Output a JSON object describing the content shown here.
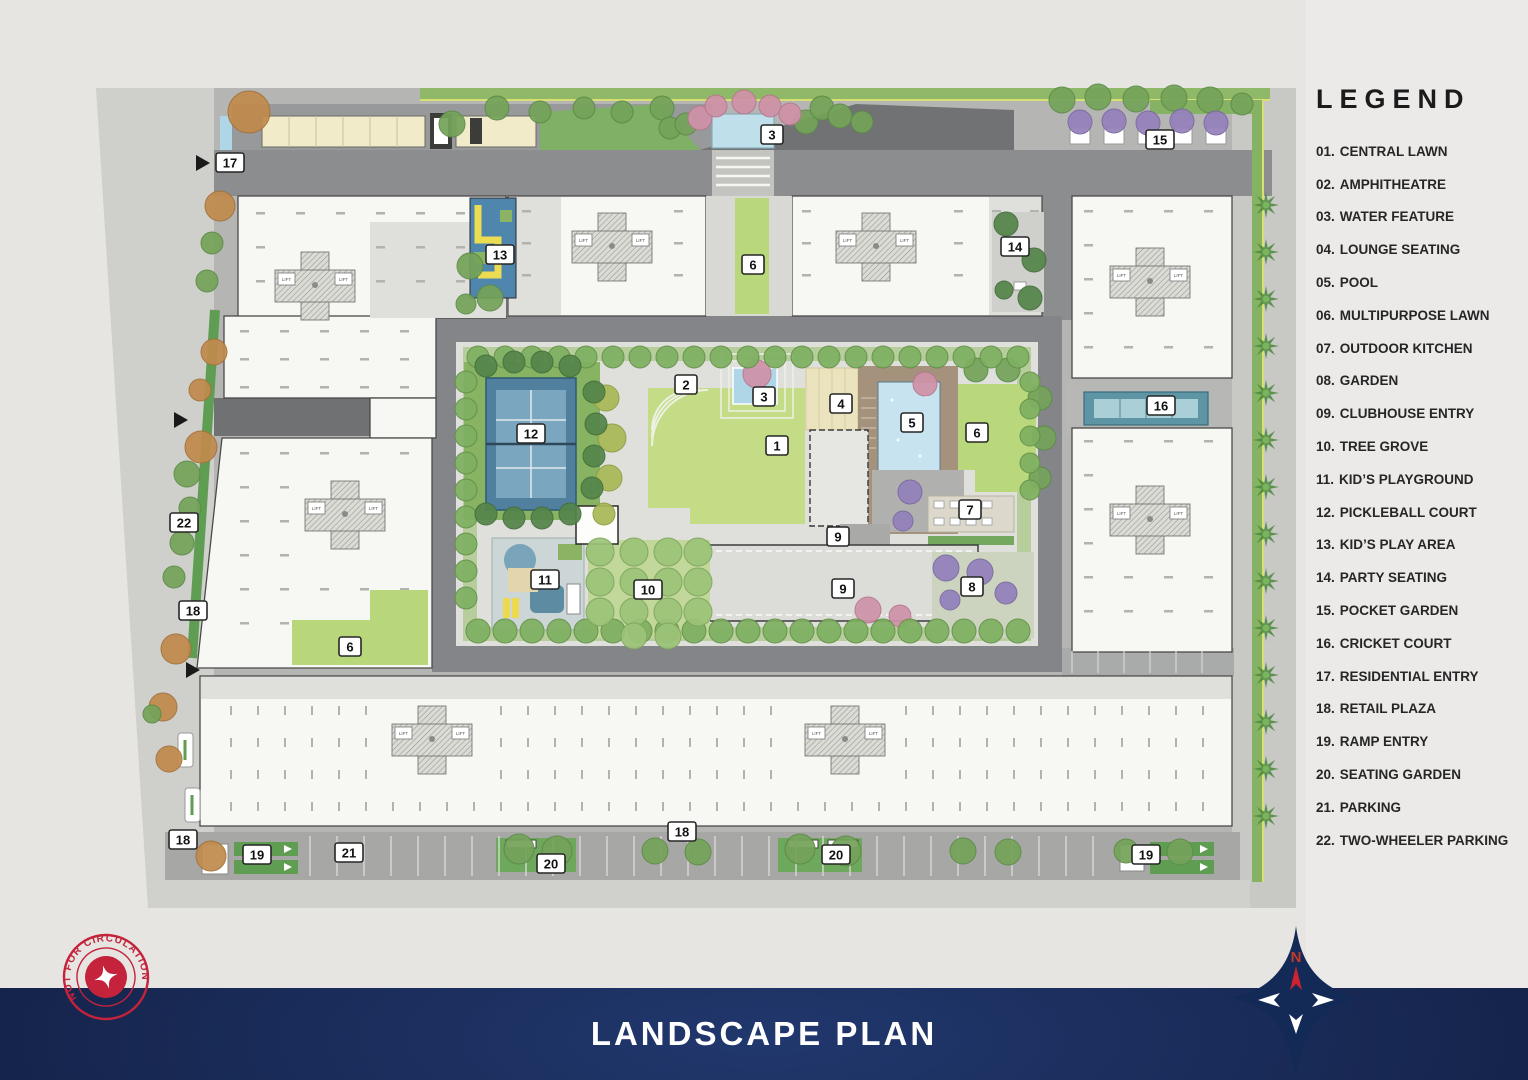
{
  "footer": {
    "title": "LANDSCAPE PLAN"
  },
  "legend": {
    "title": "LEGEND",
    "items": [
      {
        "num": "01.",
        "label": "CENTRAL LAWN"
      },
      {
        "num": "02.",
        "label": "AMPHITHEATRE"
      },
      {
        "num": "03.",
        "label": "WATER FEATURE"
      },
      {
        "num": "04.",
        "label": "LOUNGE SEATING"
      },
      {
        "num": "05.",
        "label": "POOL"
      },
      {
        "num": "06.",
        "label": "MULTIPURPOSE LAWN"
      },
      {
        "num": "07.",
        "label": "OUTDOOR KITCHEN"
      },
      {
        "num": "08.",
        "label": "GARDEN"
      },
      {
        "num": "09.",
        "label": "CLUBHOUSE ENTRY"
      },
      {
        "num": "10.",
        "label": "TREE GROVE"
      },
      {
        "num": "11.",
        "label": "KID’S PLAYGROUND"
      },
      {
        "num": "12.",
        "label": "PICKLEBALL COURT"
      },
      {
        "num": "13.",
        "label": "KID’S PLAY AREA"
      },
      {
        "num": "14.",
        "label": "PARTY SEATING"
      },
      {
        "num": "15.",
        "label": "POCKET GARDEN"
      },
      {
        "num": "16.",
        "label": "CRICKET COURT"
      },
      {
        "num": "17.",
        "label": "RESIDENTIAL ENTRY"
      },
      {
        "num": "18.",
        "label": "RETAIL PLAZA"
      },
      {
        "num": "19.",
        "label": "RAMP ENTRY"
      },
      {
        "num": "20.",
        "label": "SEATING GARDEN"
      },
      {
        "num": "21.",
        "label": "PARKING"
      },
      {
        "num": "22.",
        "label": "TWO-WHEELER PARKING"
      }
    ]
  },
  "stamp": {
    "text": "NOT FOR CIRCULATION"
  },
  "plan": {
    "compass_north": "N",
    "lift_label": "LIFT",
    "markers": [
      {
        "label": "17",
        "x": 230,
        "y": 163
      },
      {
        "label": "3",
        "x": 772,
        "y": 135
      },
      {
        "label": "15",
        "x": 1160,
        "y": 140
      },
      {
        "label": "13",
        "x": 500,
        "y": 255
      },
      {
        "label": "6",
        "x": 753,
        "y": 265
      },
      {
        "label": "14",
        "x": 1015,
        "y": 247
      },
      {
        "label": "2",
        "x": 686,
        "y": 385
      },
      {
        "label": "3",
        "x": 764,
        "y": 397
      },
      {
        "label": "4",
        "x": 841,
        "y": 404
      },
      {
        "label": "5",
        "x": 912,
        "y": 423
      },
      {
        "label": "6",
        "x": 977,
        "y": 433
      },
      {
        "label": "12",
        "x": 531,
        "y": 434
      },
      {
        "label": "16",
        "x": 1161,
        "y": 406
      },
      {
        "label": "1",
        "x": 777,
        "y": 446
      },
      {
        "label": "22",
        "x": 184,
        "y": 523
      },
      {
        "label": "7",
        "x": 970,
        "y": 510
      },
      {
        "label": "9",
        "x": 838,
        "y": 537
      },
      {
        "label": "18",
        "x": 193,
        "y": 611
      },
      {
        "label": "11",
        "x": 545,
        "y": 580
      },
      {
        "label": "10",
        "x": 648,
        "y": 590
      },
      {
        "label": "9",
        "x": 843,
        "y": 589
      },
      {
        "label": "8",
        "x": 972,
        "y": 587
      },
      {
        "label": "6",
        "x": 350,
        "y": 647
      },
      {
        "label": "18",
        "x": 183,
        "y": 840
      },
      {
        "label": "19",
        "x": 257,
        "y": 855
      },
      {
        "label": "21",
        "x": 349,
        "y": 853
      },
      {
        "label": "20",
        "x": 551,
        "y": 864
      },
      {
        "label": "18",
        "x": 682,
        "y": 832
      },
      {
        "label": "20",
        "x": 836,
        "y": 855
      },
      {
        "label": "19",
        "x": 1146,
        "y": 855
      }
    ],
    "colors": {
      "band_navy": "#16264f",
      "stamp_red": "#c5223b",
      "compass_navy": "#142a56",
      "lawn_green": "#c3dc85",
      "water_blue": "#bfe0ea",
      "road_dark": "#85878a"
    }
  }
}
